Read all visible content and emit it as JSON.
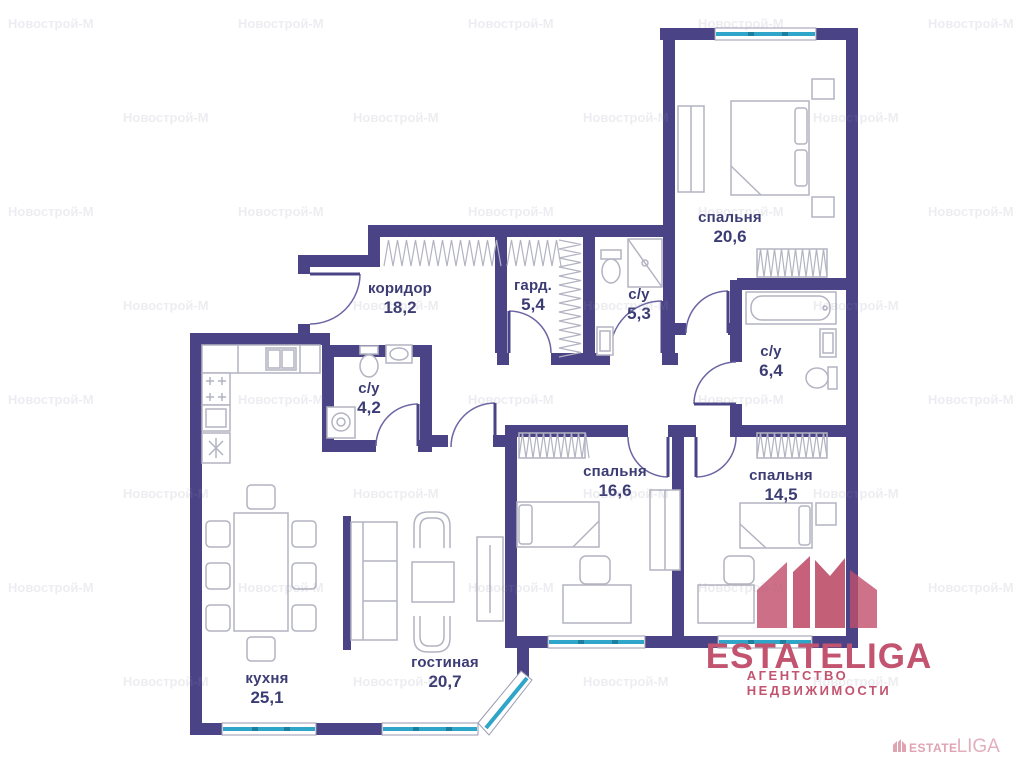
{
  "branding": {
    "logo_text": "ESTATELIGA",
    "logo_subtitle": "АГЕНТСТВО НЕДВИЖИМОСТИ",
    "mini_estate": "ESTATE",
    "mini_liga": "LIGA"
  },
  "watermark": {
    "text": "Новострой-М"
  },
  "rooms": [
    {
      "id": "bedroom-1",
      "name": "спальня",
      "area": "20,6"
    },
    {
      "id": "corridor",
      "name": "коридор",
      "area": "18,2"
    },
    {
      "id": "wardrobe",
      "name": "гард.",
      "area": "5,4"
    },
    {
      "id": "bathroom-1",
      "name": "с/у",
      "area": "5,3"
    },
    {
      "id": "bathroom-2",
      "name": "с/у",
      "area": "6,4"
    },
    {
      "id": "bathroom-3",
      "name": "с/у",
      "area": "4,2"
    },
    {
      "id": "bedroom-2",
      "name": "спальня",
      "area": "16,6"
    },
    {
      "id": "bedroom-3",
      "name": "спальня",
      "area": "14,5"
    },
    {
      "id": "kitchen",
      "name": "кухня",
      "area": "25,1"
    },
    {
      "id": "living-room",
      "name": "гостиная",
      "area": "20,7"
    }
  ],
  "colors": {
    "wall": "#4a4487",
    "window": "#2fa6c9",
    "logo": "#c25470",
    "label": "#3c3c74",
    "fur": "#b3b3c2"
  }
}
